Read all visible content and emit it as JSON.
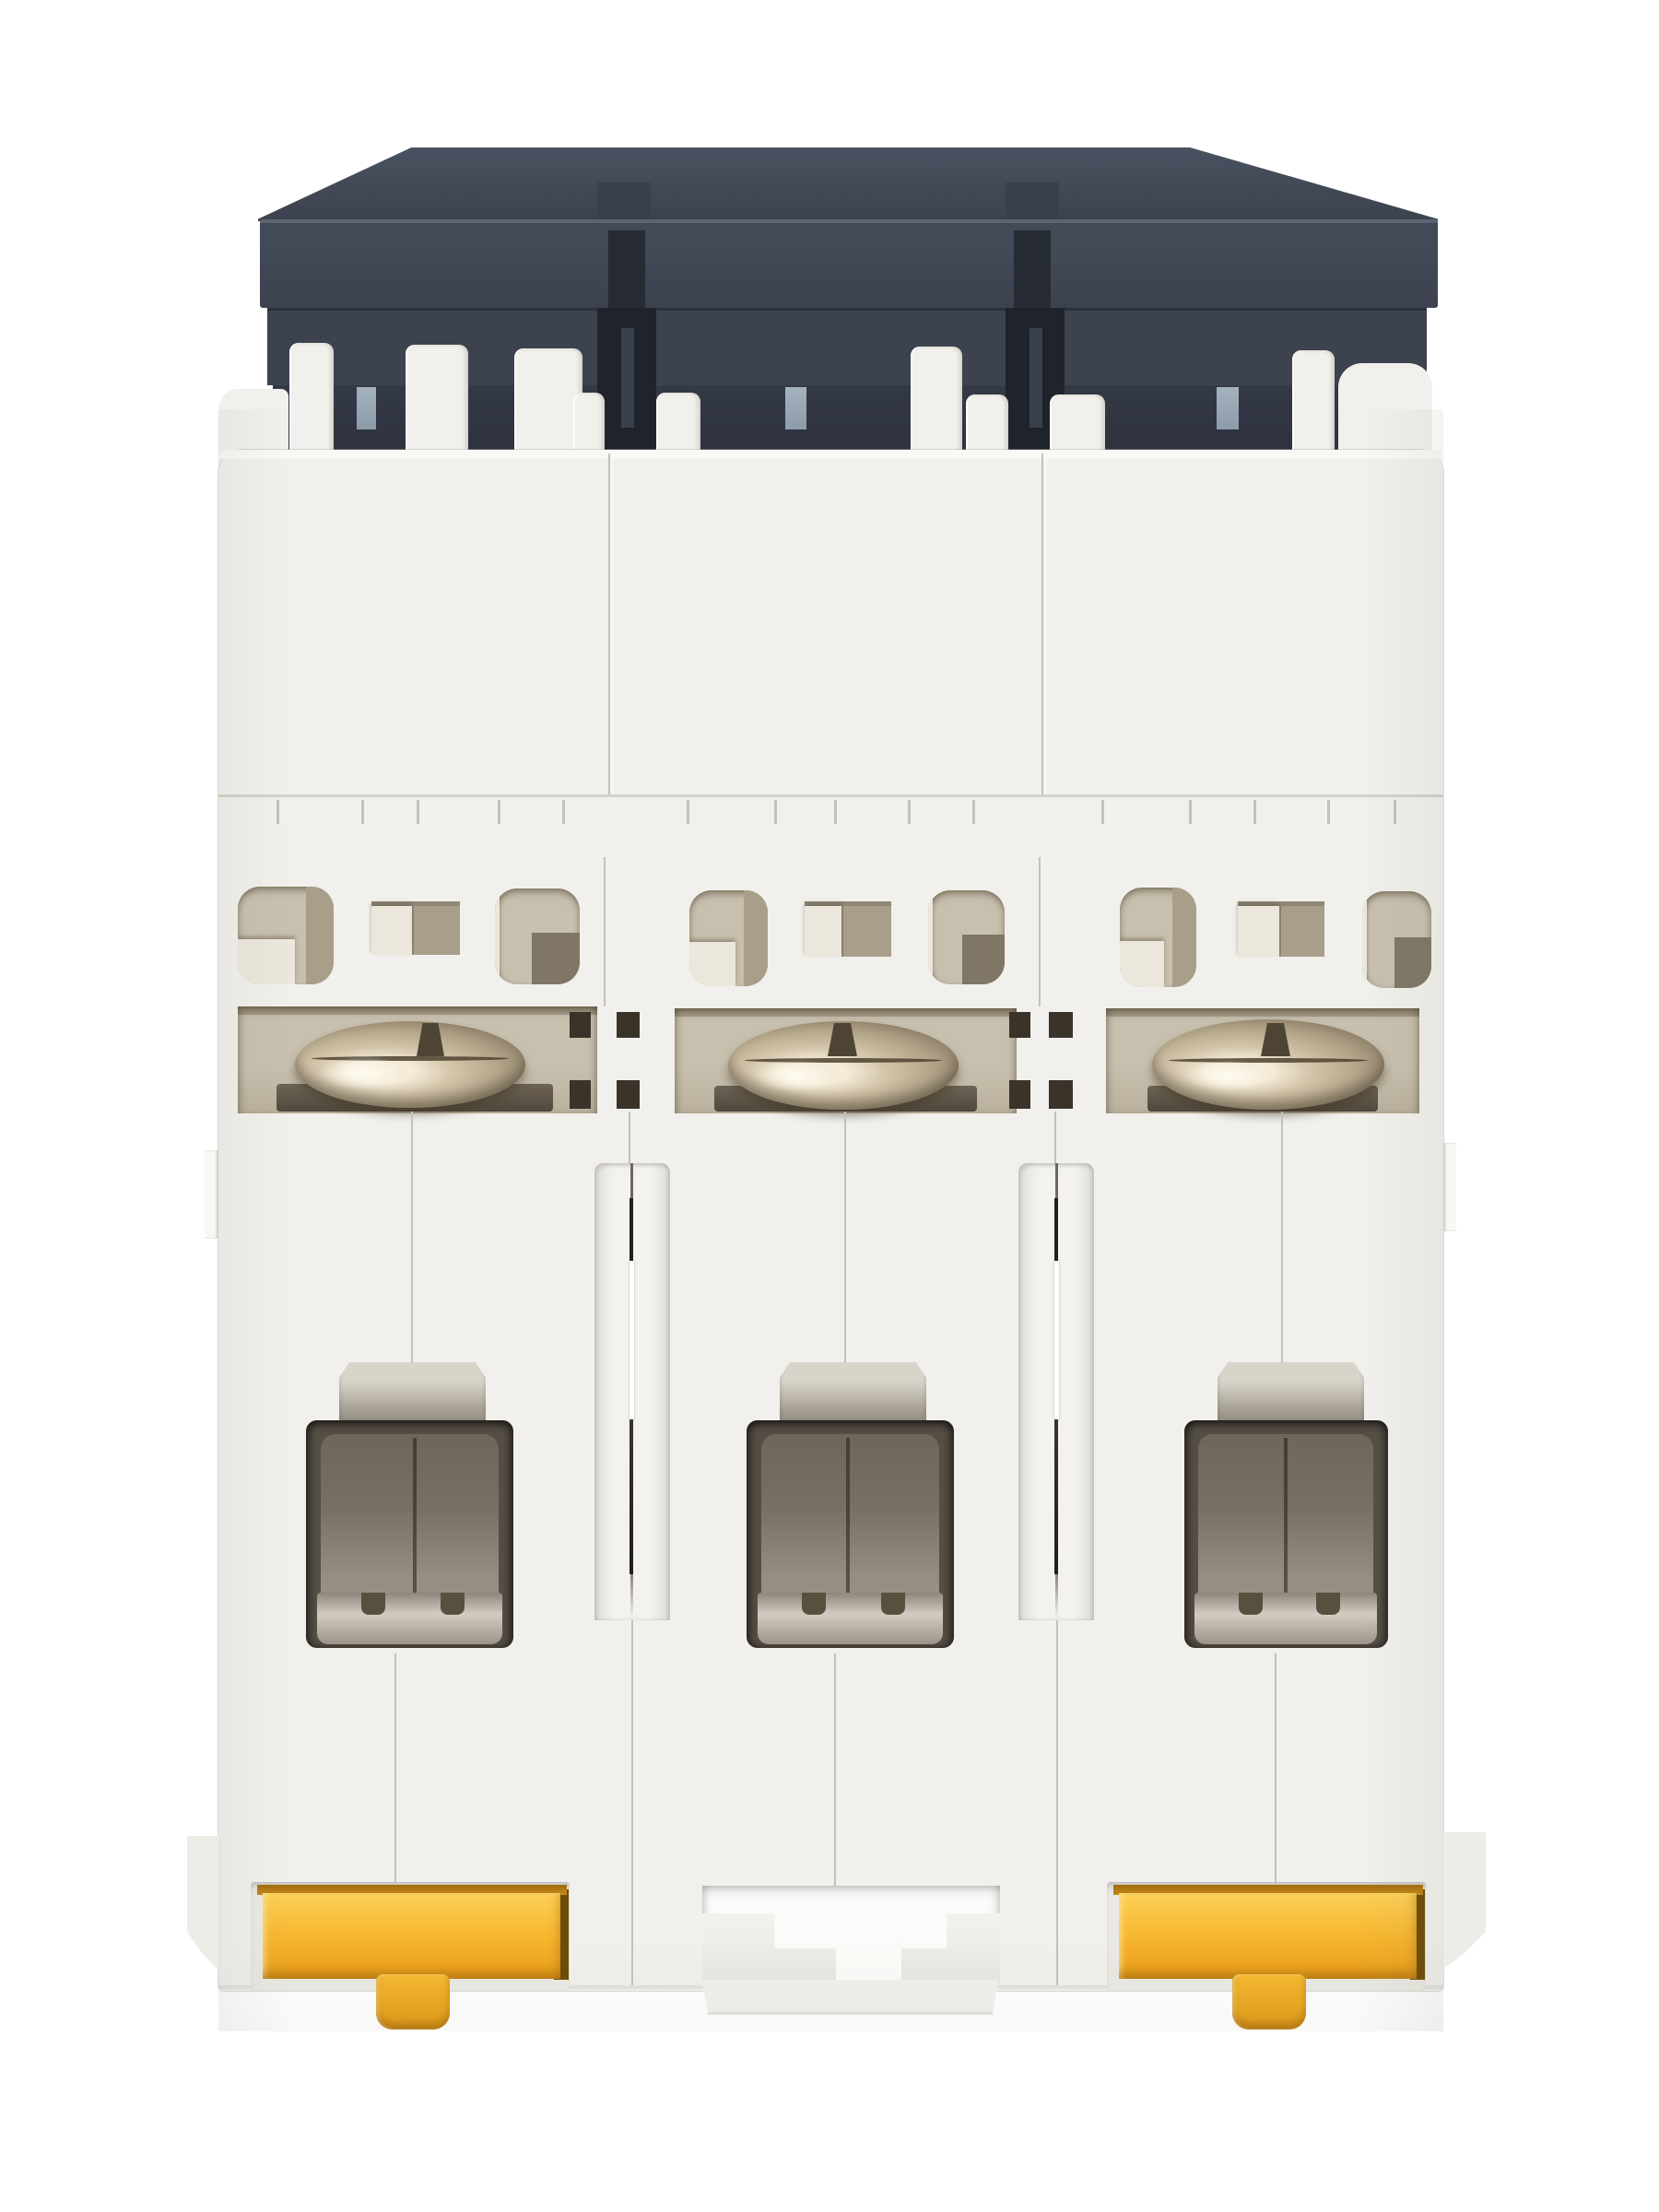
{
  "image": {
    "description": "Bottom rear view of a white 3-pole DIN-rail miniature circuit breaker: dark grey toggle assembly at top, three white pole modules with vent openings, three slotted terminal screws, three rectangular terminal cages, and yellow DIN-rail release clips on the outer poles with a T-shaped rail slot on the centre pole",
    "subject": "three-pole miniature circuit breaker",
    "view": "bottom rear",
    "pole_count": 3,
    "terminal_screw_count": 3,
    "din_clip_count": 2,
    "din_clip_poles": [
      "pole-1",
      "pole-3"
    ],
    "indicator_window_count": 3
  },
  "colors": {
    "bg": "#ffffff",
    "plastic": "#f1f0ec",
    "plastic-hi": "#f9f8f5",
    "plastic-sh": "#e2e1db",
    "seam": "#c2c1ba",
    "seam-dark": "#918f87",
    "cap": "#3c424e",
    "cap-top": "#4a5160",
    "cap-hi": "#5c6473",
    "cap-dark": "#2c313b",
    "cap-slot": "#1f242c",
    "indicator": "#a4b2c0",
    "cavity": "#c8c0ae",
    "cavity-dark": "#a89e8a",
    "cavity-deep": "#7f7665",
    "cavity-hi": "#ebe7dc",
    "screw-hi": "#f4ebd8",
    "screw": "#b3a58a",
    "screw-dark": "#6f6450",
    "tabmetal-hi": "#d9d4ca",
    "tabmetal": "#a19a8e",
    "cage": "#786f63",
    "cage-hi": "#958d80",
    "cage-dark": "#554e45",
    "metalband-hi": "#d2ccc2",
    "clip": "#f6b42c",
    "clip-hi": "#fdd056",
    "clip-dark": "#e19a16",
    "clip-lip": "#a06c0c",
    "clip-deep": "#6e4b06"
  }
}
